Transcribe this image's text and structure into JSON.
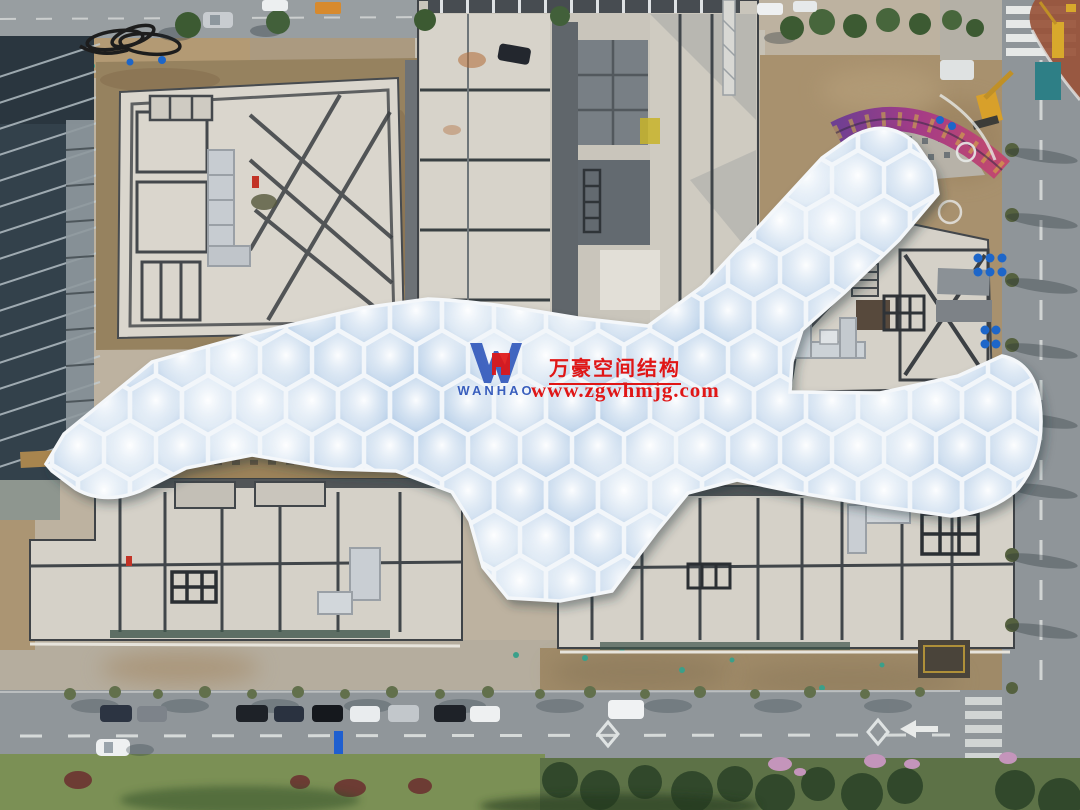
{
  "watermark": {
    "logo_text": "WANHAO",
    "company_name": "万豪空间结构",
    "website": "www.zgwhmjg.com",
    "text_color": "#e01616",
    "logo_color": "#2a52b8"
  },
  "scene_palette": {
    "canopy_frame": "#f2f6fa",
    "canopy_cushion": "#b9cfe6",
    "concrete_roof": "#d6d2c9",
    "asphalt": "#90969a",
    "dirt": "#a8916e",
    "vegetation": "#4a6b3a",
    "accent_ribbon": "#a53c86"
  }
}
